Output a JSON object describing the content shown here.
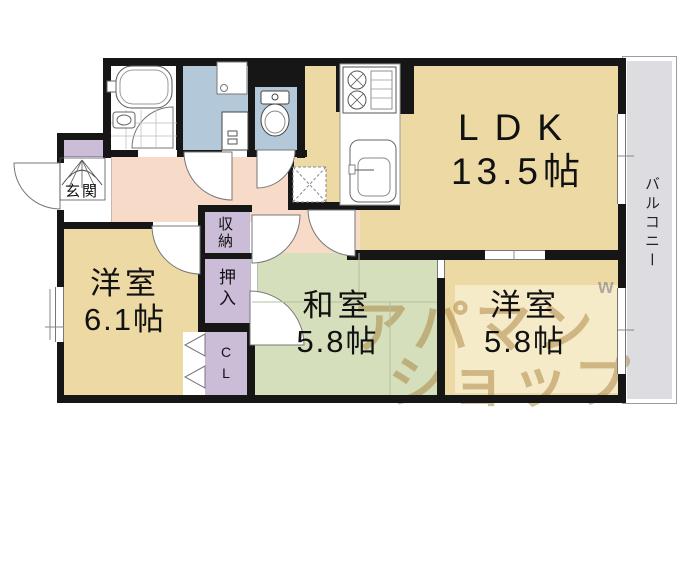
{
  "rooms": {
    "ldk": {
      "name": "LDK",
      "size": "13.5帖"
    },
    "bedroom_west": {
      "name": "洋室",
      "size": "6.1帖"
    },
    "bedroom_japanese": {
      "name": "和室",
      "size": "5.8帖"
    },
    "bedroom_south": {
      "name": "洋室",
      "size": "5.8帖"
    }
  },
  "areas": {
    "balcony": "バルコニー",
    "entrance": "玄関",
    "storage": "収納",
    "oshiire": "押入",
    "closet_c": "C",
    "closet_l": "L"
  },
  "watermark": {
    "line1": "アパマン",
    "line2": "ショップ",
    "mark": "w"
  },
  "colors": {
    "room_tan": "#ecd9a4",
    "tatami_green": "#d5dfbc",
    "hallway_pink": "#f7dac8",
    "wet_area_blue": "#b3c9da",
    "closet_purple": "#cbbcd8",
    "balcony_gray": "#dcdce1",
    "wall": "#161616",
    "watermark_tan": "#b08a46"
  }
}
